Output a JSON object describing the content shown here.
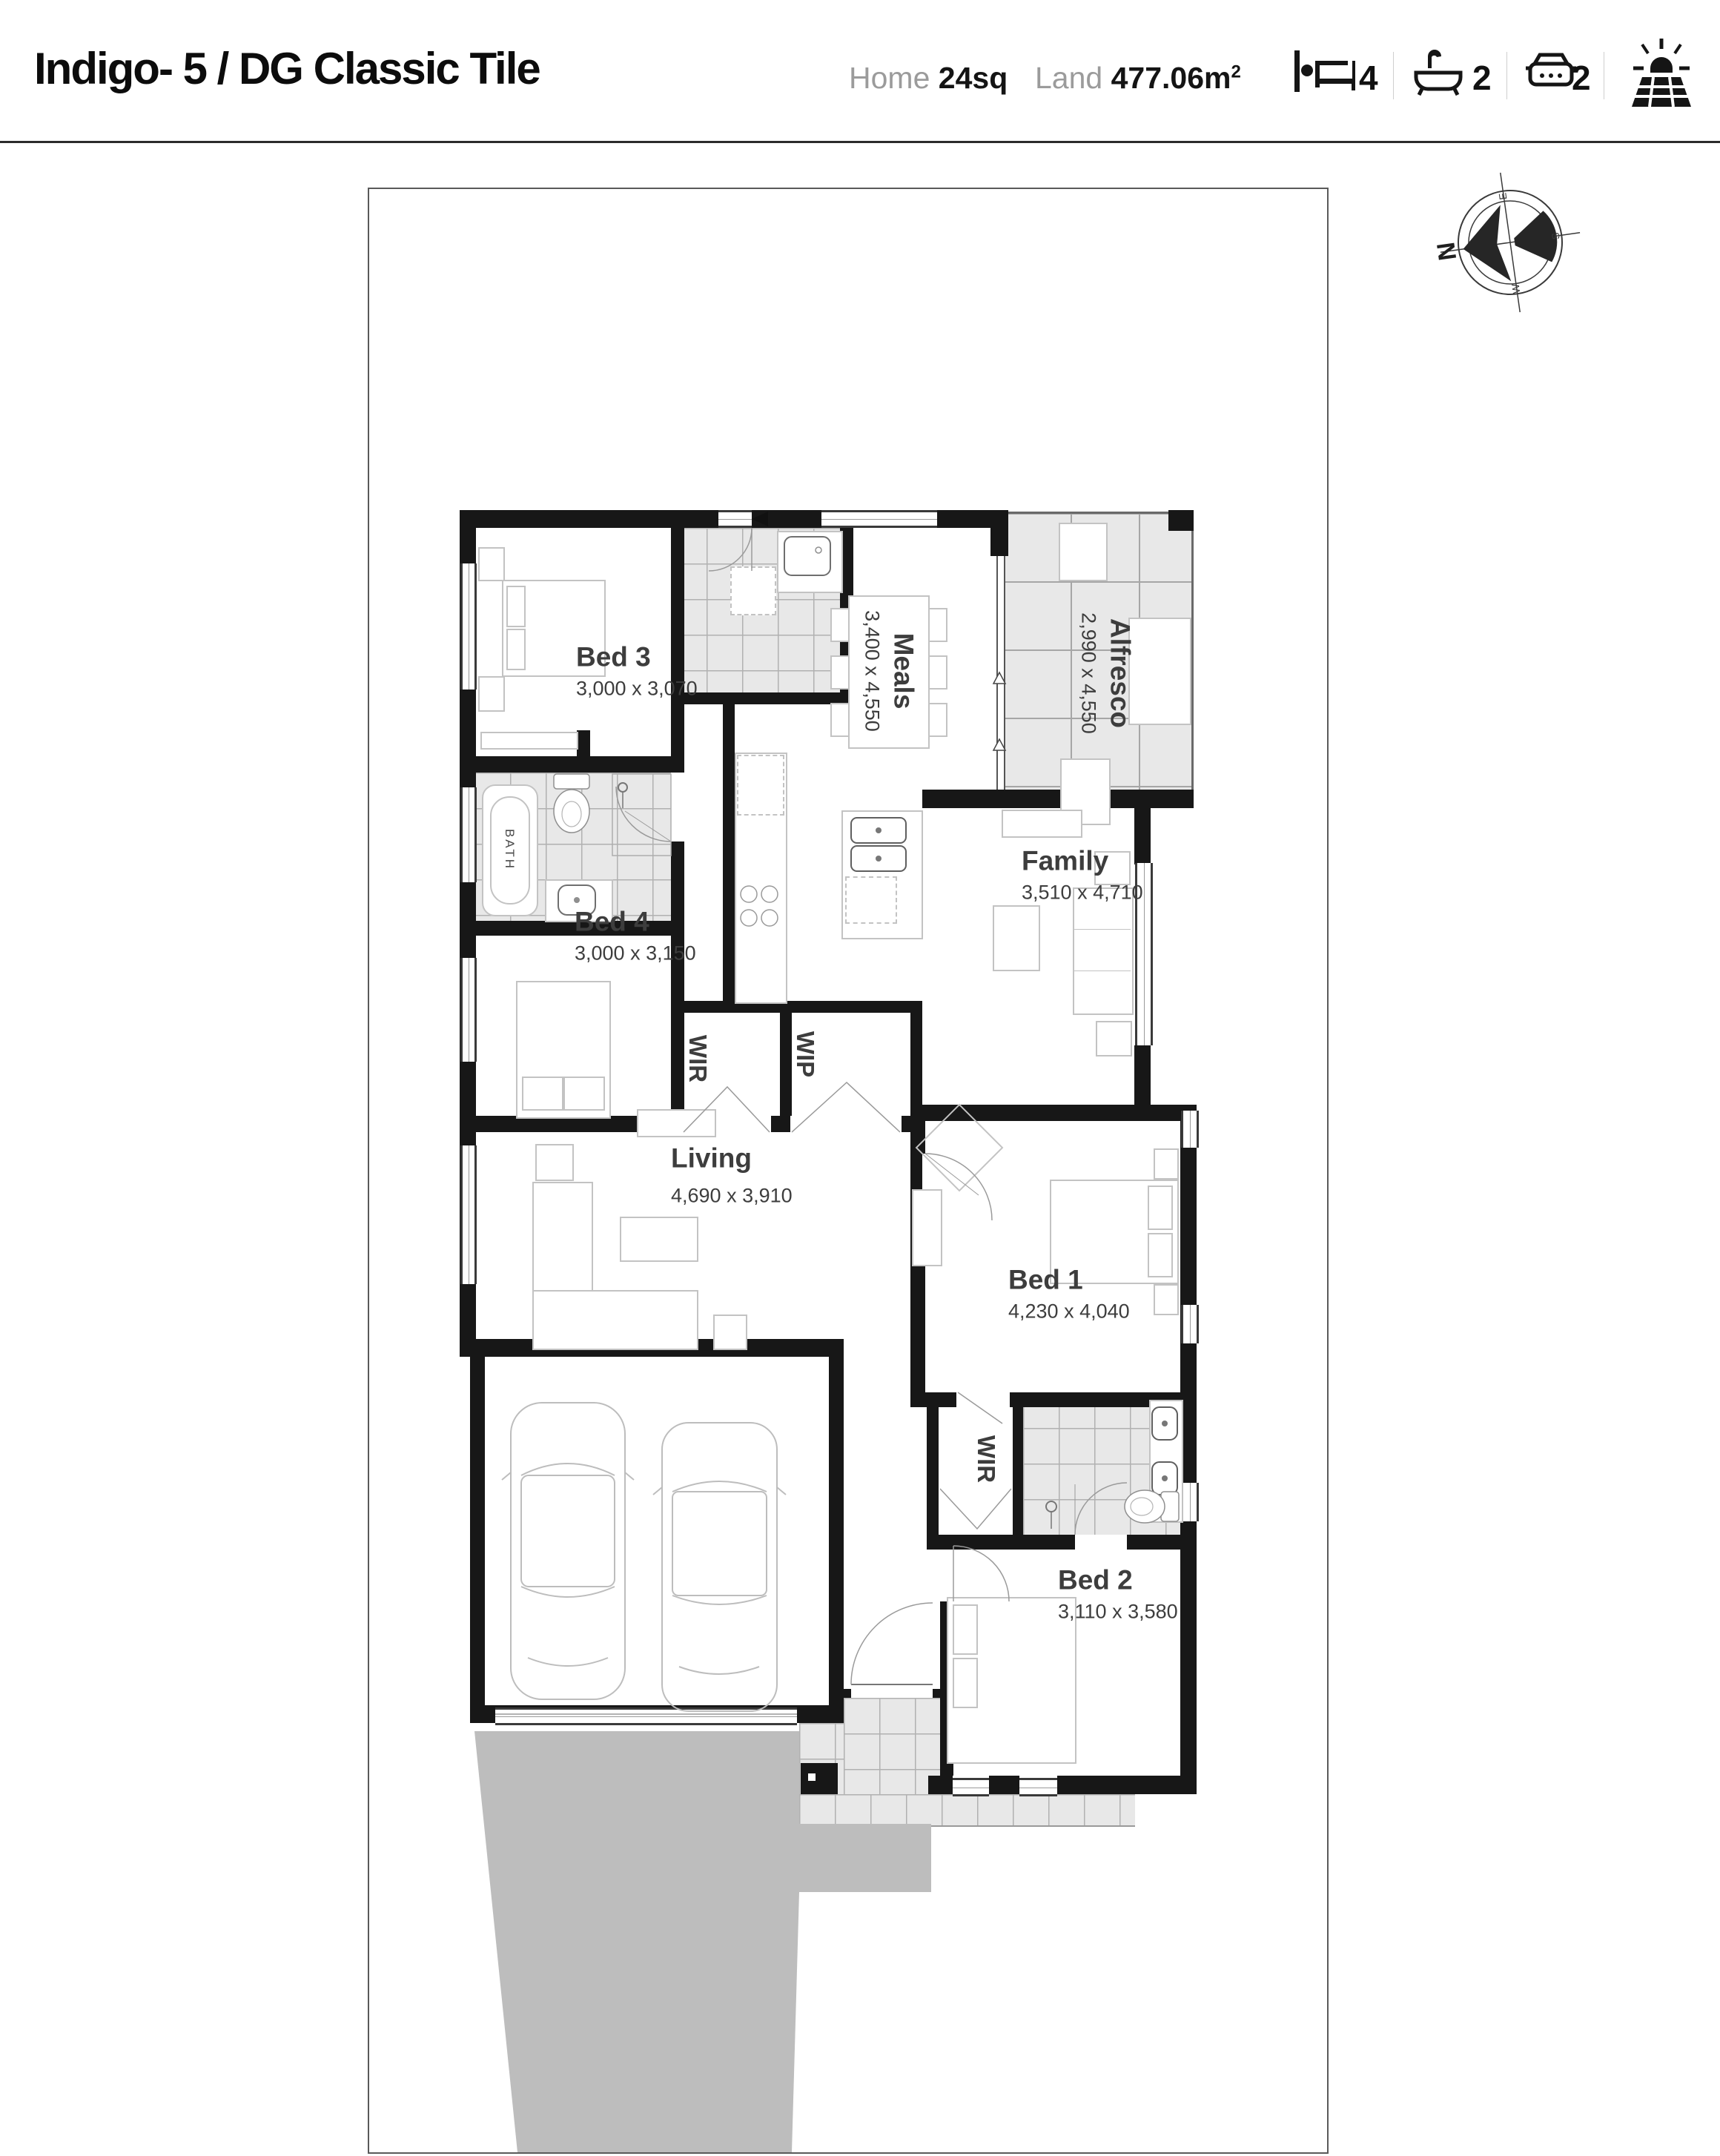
{
  "header": {
    "title": "Indigo- 5 / DG Classic Tile",
    "home_label": "Home",
    "home_value": "24sq",
    "land_label": "Land",
    "land_value": "477.06m",
    "land_sup": "2",
    "bed_count": "4",
    "bath_count": "2",
    "car_count": "2"
  },
  "compass": {
    "north": "N",
    "east": "E",
    "south": "S",
    "west": "W"
  },
  "rooms": {
    "bed3": {
      "label": "Bed 3",
      "dims": "3,000 x 3,070"
    },
    "bed4": {
      "label": "Bed 4",
      "dims": "3,000 x 3,150"
    },
    "living": {
      "label": "Living",
      "dims": "4,690 x 3,910"
    },
    "meals": {
      "label": "Meals",
      "dims": "3,400 x 4,550"
    },
    "alfresco": {
      "label": "Alfresco",
      "dims": "2,990 x 4,550"
    },
    "family": {
      "label": "Family",
      "dims": "3,510 x 4,710"
    },
    "bed1": {
      "label": "Bed 1",
      "dims": "4,230 x 4,040"
    },
    "bed2": {
      "label": "Bed 2",
      "dims": "3,110 x 3,580"
    },
    "wir_hall": {
      "label": "WIR"
    },
    "wip": {
      "label": "WIP"
    },
    "wir_master": {
      "label": "WIR"
    },
    "bath": {
      "label": "BATH"
    }
  }
}
